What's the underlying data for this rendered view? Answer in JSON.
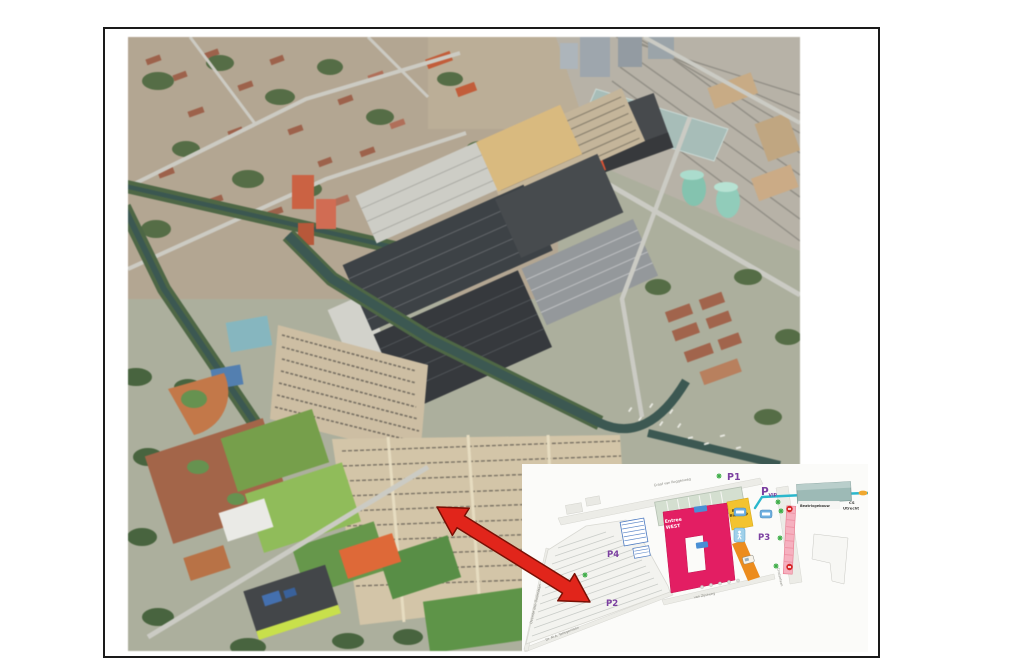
{
  "page": {
    "background": "#ffffff",
    "frame_border": "#1a1a1a"
  },
  "aerial_photo": {
    "palette": {
      "ground": "#a9ac98",
      "halls_roof": "#353a3e",
      "parking": "#d3c3a3",
      "water": "#33514b",
      "trees": "#4d673c",
      "sports_green": "#6f9c3f",
      "clay": "#a35d3f",
      "station_roof": "#a3bab5",
      "red_building": "#e14a28"
    }
  },
  "arrow": {
    "color": "#e1251b",
    "outline": "#7a1005"
  },
  "inset_map": {
    "colors": {
      "purple": "#7b3fa0",
      "pink_building": "#e31e63",
      "yellow_building": "#f3c32f",
      "route": "#2ab7cc",
      "orange_path": "#ec8c1e",
      "green_marker": "#3fae49",
      "stripe_pink": "#f6b0bf",
      "stripe_red": "#d62828",
      "beatrix_teal": "#9dbab6"
    },
    "parking_labels": [
      {
        "id": "P1",
        "label": "P1"
      },
      {
        "id": "PVIP",
        "label": "P",
        "sub": "VIP"
      },
      {
        "id": "P2",
        "label": "P2"
      },
      {
        "id": "P3",
        "label": "P3"
      },
      {
        "id": "P4",
        "label": "P4"
      }
    ],
    "buildings": {
      "entree_line1": "Entree",
      "entree_line2": "WEST",
      "bioscoop_line1": "Beurs",
      "bioscoop_line2": "Bioscoop",
      "beatrixgebouw": "Beatrixgebouw",
      "cs_line1": "CS",
      "cs_line2": "Utrecht"
    },
    "streets": {
      "graaf_van_roggenweg": "Graaf van Roggenweg",
      "croeselaan": "Croeselaan",
      "van_zijstweg": "van Zijstweg",
      "tellegenlaan": "Dr. M.A. Tellegenlaan",
      "oudenlaan": "Overste den Oudenlaan"
    },
    "icons": {
      "entrance_marker": "green asterisk",
      "pedestrian": "white walking figure on light blue",
      "bus_stop": "white bus on blue badge",
      "shuttle": "white shuttle van on orange path",
      "stop_marker": "red circle"
    }
  }
}
